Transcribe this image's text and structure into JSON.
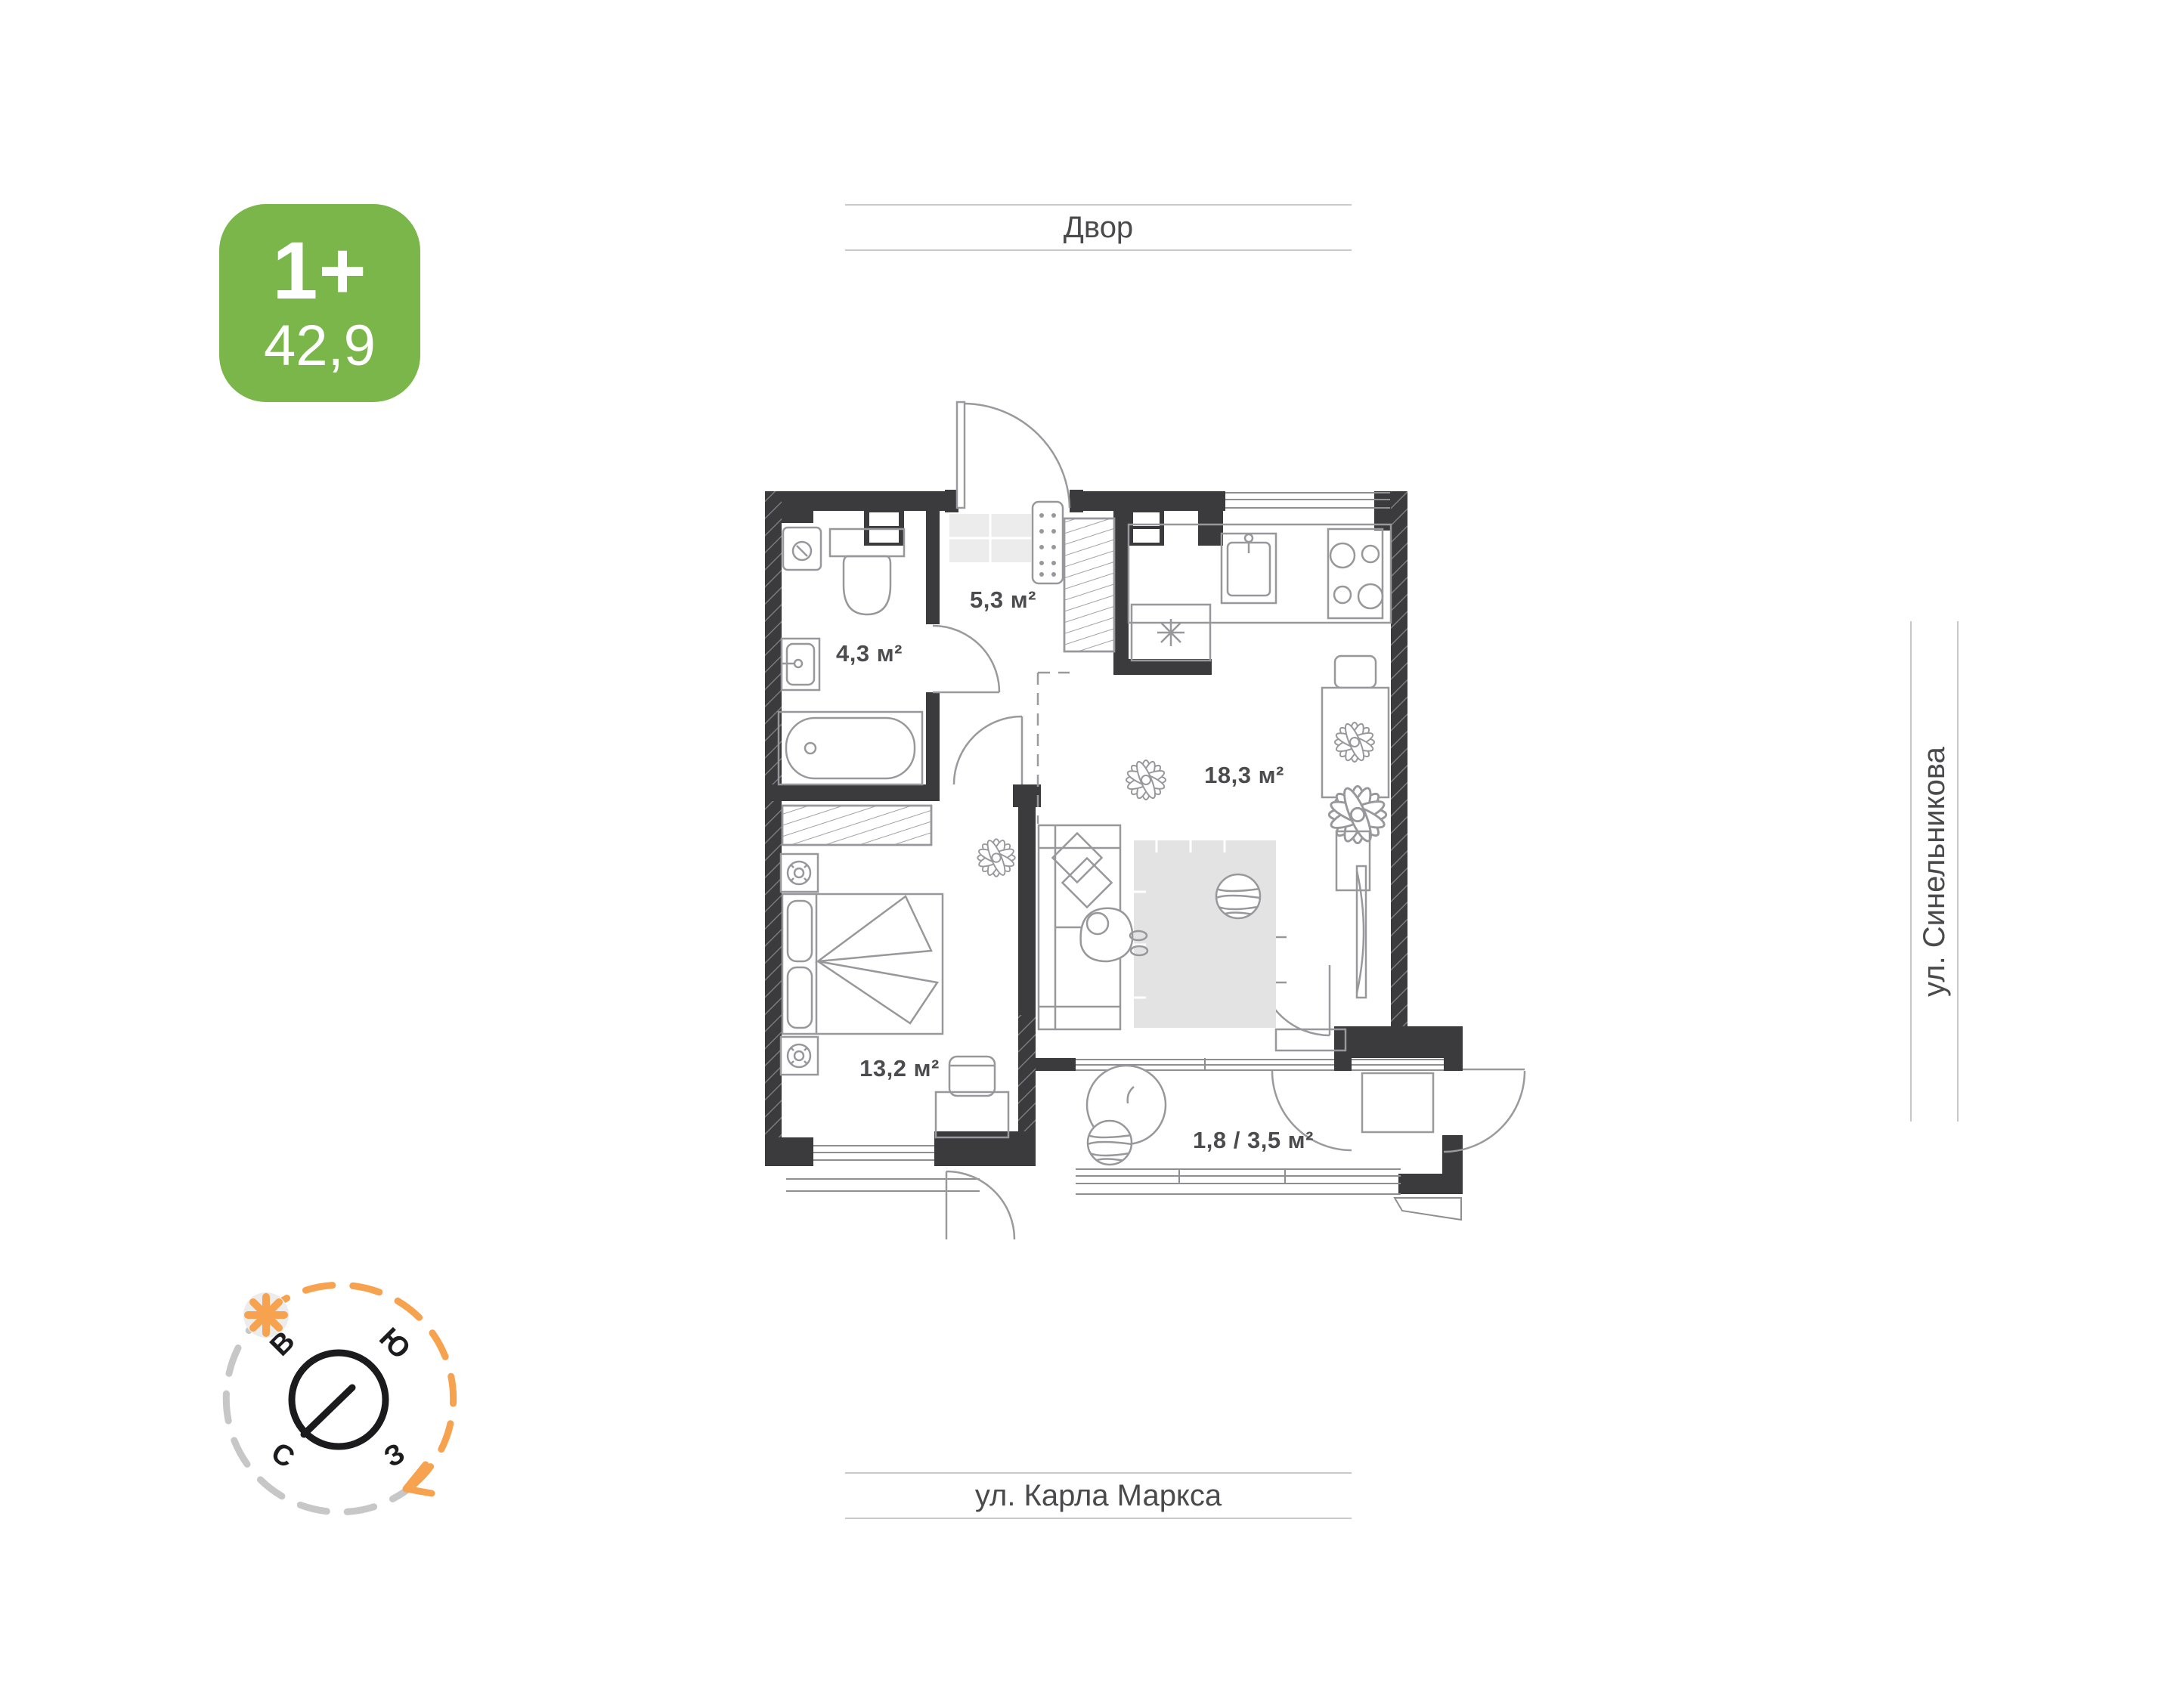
{
  "badge": {
    "type_label": "1+",
    "area_value": "42,9",
    "color": "#7ab64a"
  },
  "surroundings": {
    "yard": "Двор",
    "street_right": "ул. Синельникова",
    "street_bottom": "ул. Карла Маркса"
  },
  "plan": {
    "rooms": [
      {
        "name": "hallway",
        "area": "5,3 м²"
      },
      {
        "name": "bathroom",
        "area": "4,3 м²"
      },
      {
        "name": "kitchen-living-room",
        "area": "18,3 м²"
      },
      {
        "name": "bedroom",
        "area": "13,2 м²"
      },
      {
        "name": "balcony",
        "area": "1,8 / 3,5 м²"
      }
    ]
  },
  "compass": {
    "north": "С",
    "south": "Ю",
    "east": "В",
    "west": "З"
  },
  "colors": {
    "badge_green": "#7ab64a",
    "accent_orange": "#f7a24e",
    "wall_dark": "#3b3b3e",
    "furniture_gray": "#98989c",
    "label_gray": "#4c4c4f",
    "band_line_gray": "#c9c9c9"
  }
}
